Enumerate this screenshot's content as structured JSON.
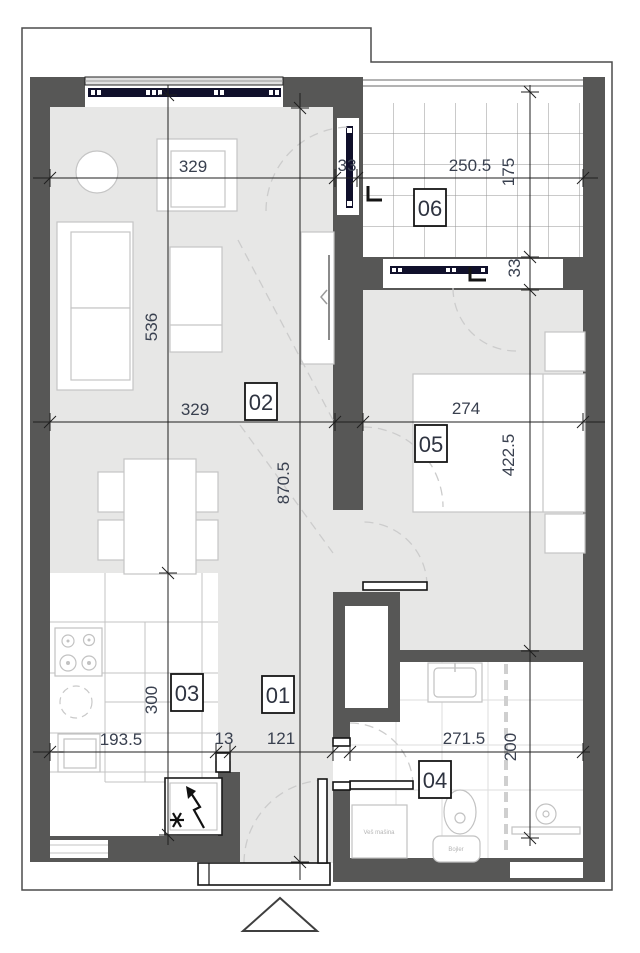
{
  "title": "Apartment floor plan",
  "rooms": [
    {
      "number": "01",
      "name": "hallway"
    },
    {
      "number": "02",
      "name": "living-dining"
    },
    {
      "number": "03",
      "name": "kitchen"
    },
    {
      "number": "04",
      "name": "bathroom"
    },
    {
      "number": "05",
      "name": "bedroom"
    },
    {
      "number": "06",
      "name": "balcony"
    }
  ],
  "dimensions": {
    "top_living_width": "329",
    "top_wall_thickness": "33",
    "balcony_width": "250.5",
    "balcony_depth": "175",
    "balcony_wall_thickness": "33",
    "living_length": "536",
    "kitchen_depth": "300",
    "apartment_length": "870.5",
    "mid_living_width": "329",
    "bedroom_width": "274",
    "bedroom_length": "422.5",
    "kitchen_width": "193.5",
    "partition_thickness": "13",
    "hall_width": "121",
    "bathroom_width": "271.5",
    "bathroom_depth": "200"
  },
  "fixtures": {
    "washing_machine_label": "Veš mašina",
    "boiler_label": "Bojler"
  },
  "colors": {
    "wall": "#575756",
    "floor": "#e7e7e6",
    "window": "#10102b",
    "dim_text": "#39404f"
  }
}
